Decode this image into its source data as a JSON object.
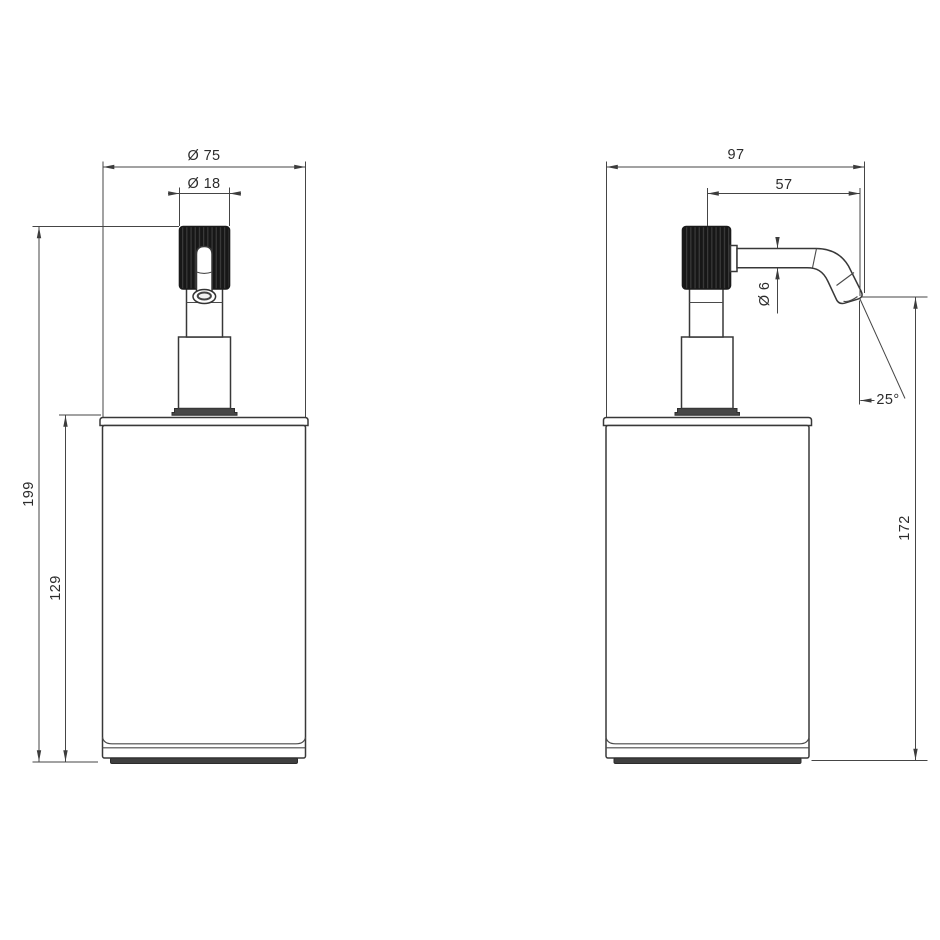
{
  "front_view": {
    "dims": {
      "overall_diameter": "Ø 75",
      "pump_cap_diameter": "Ø 18",
      "total_height": "199",
      "body_height": "129"
    }
  },
  "side_view": {
    "dims": {
      "overall_depth": "97",
      "spout_reach": "57",
      "spout_tube_diameter": "Ø 6",
      "spout_angle": "25°",
      "height_to_spout": "172"
    }
  },
  "colors": {
    "object_line": "#383838",
    "dimension_line": "#454545",
    "text": "#2c2c2c",
    "cap_fill": "#171717",
    "cap_knurl_stripe": "#3e3e3e",
    "flange_fill": "#474747",
    "base_fill": "#3f3f3f",
    "background": "#ffffff"
  }
}
